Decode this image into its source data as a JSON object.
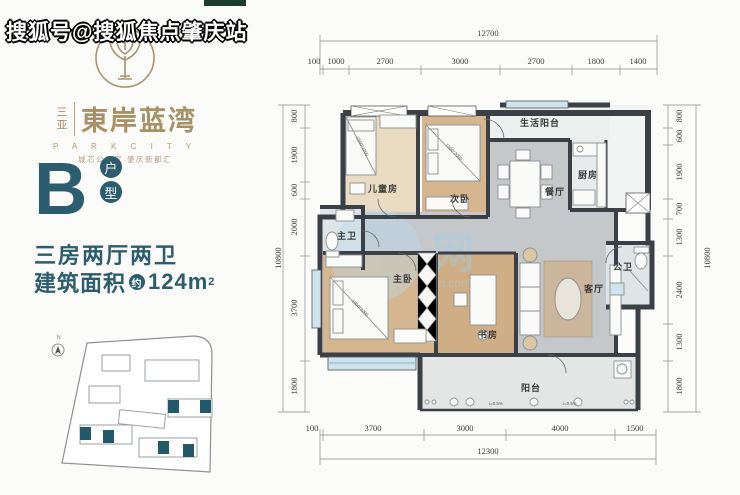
{
  "watermark_overlay": "搜狐号@搜狐焦点肇庆站",
  "logo": {
    "city": "三亚",
    "name": "東岸蓝湾",
    "subtitle": "P A R K C I T Y",
    "tagline": "城芯公园家·肇庆新都汇"
  },
  "unit": {
    "letter": "B",
    "badge_top": "户",
    "badge_bottom": "型",
    "layout": "三房两厅两卫",
    "area_prefix": "建筑面积",
    "area_circled": "约",
    "area_value": "124m",
    "area_sup": "2"
  },
  "colors": {
    "accent": "#2b5d6e",
    "gold": "#a8906a",
    "wall": "#3b4046"
  },
  "siteplan": {
    "compass": "N"
  },
  "plan_watermark": {
    "glyph": "网",
    "suffix": "m.com"
  },
  "floorplan": {
    "rooms": {
      "children": "儿童房",
      "second": "次卧",
      "service_balcony": "生活阳台",
      "dining": "餐厅",
      "kitchen": "厨房",
      "master_bath": "主卫",
      "master": "主卧",
      "study": "书房",
      "living": "客厅",
      "guest_bath": "公卫",
      "balcony": "阳台"
    },
    "furniture_labels": {
      "children_bed": "1500*2200",
      "second_bed": "1500*2000",
      "master_bed": "1800*2200"
    },
    "slope_labels": [
      "i=0.5%",
      "i=0.5%"
    ],
    "dims": {
      "top_total": "12700",
      "top": [
        "100",
        "1000",
        "2700",
        "3000",
        "2700",
        "1800",
        "1400"
      ],
      "left_total": "10800",
      "left": [
        "800",
        "1900",
        "600",
        "2000",
        "3700",
        "1800"
      ],
      "right_total": "10800",
      "right": [
        "800",
        "600",
        "1900",
        "700",
        "1300",
        "2400",
        "1300",
        "1800"
      ],
      "bottom": [
        "100",
        "3700",
        "3000",
        "4000",
        "1500"
      ],
      "bottom_total": "12300"
    }
  }
}
